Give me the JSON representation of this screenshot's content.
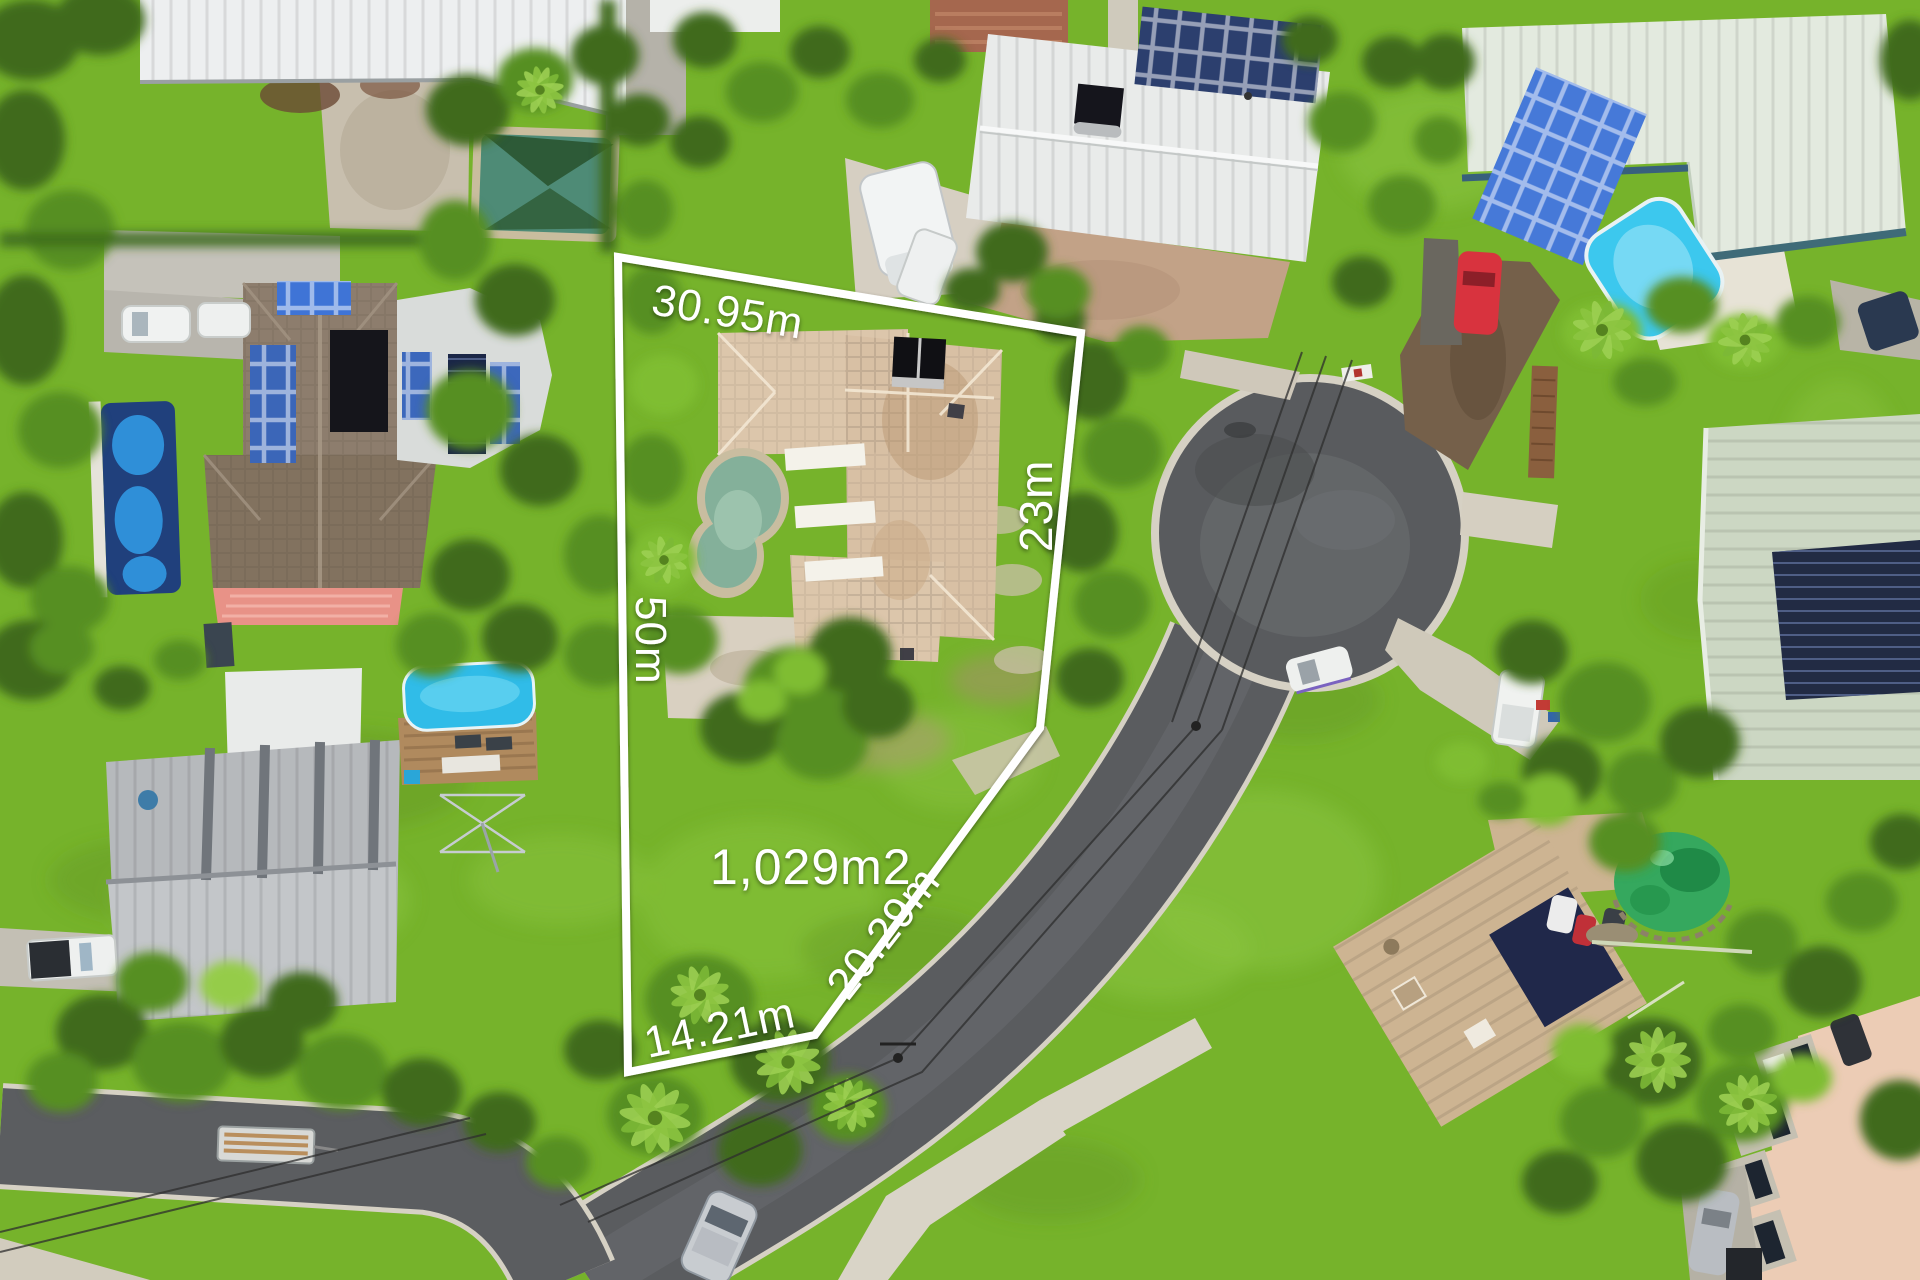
{
  "meta": {
    "description": "Aerial drone photograph of a residential subdivision with a highlighted vacant-home lot, white boundary overlay and lot dimensions",
    "width_px": 1920,
    "height_px": 1280
  },
  "overlay": {
    "boundary_color": "#ffffff",
    "labels": {
      "top_edge": "30.95m",
      "right_edge": "23m",
      "left_edge": "50m",
      "diagonal_edge": "20.29m",
      "bottom_edge": "14.21m",
      "area": "1,029m2"
    }
  },
  "scene": {
    "objects": [
      "subject-house-beige-roof",
      "kidney-pool",
      "cul-de-sac",
      "residential-street",
      "white-shed-roof",
      "brown-roof-house-with-solar",
      "lap-pool",
      "shade-sail-pool",
      "grey-metal-roof-house",
      "blue-pool-with-deck",
      "clothesline",
      "white-roof-house-with-solar",
      "caravan",
      "mint-roof-house",
      "bright-blue-pool",
      "sage-roof-house",
      "tan-roof-house",
      "green-pond",
      "salmon-apartment-roof",
      "cars",
      "white-ute",
      "timber-trailer",
      "power-lines",
      "footpaths",
      "palm-trees",
      "lawns"
    ],
    "palette": {
      "grass": "#76b32b",
      "grass_light": "#8bc63f",
      "foliage_dark": "#3f6b1d",
      "foliage_mid": "#578f23",
      "foliage_light": "#7fbd33",
      "asphalt": "#5a5c5f",
      "concrete": "#d7d2c4",
      "dirt_drive": "#75604a",
      "roof_white": "#eceeed",
      "roof_brown": "#8a7a6a",
      "roof_beige": "#dcc6ab",
      "roof_grey": "#b7babd",
      "roof_mint": "#e3eadf",
      "roof_sage": "#ccd7c3",
      "roof_tan": "#cdb492",
      "roof_salmon": "#ecccb5",
      "pool_blue": "#35c0ea",
      "pool_teal": "#84b09a",
      "pond_green": "#35a85e",
      "pool_navy": "#20407c",
      "solar_blue": "#4679d8",
      "solar_navy": "#20284a",
      "car_red": "#d8333e",
      "overlay_white": "#ffffff"
    }
  }
}
